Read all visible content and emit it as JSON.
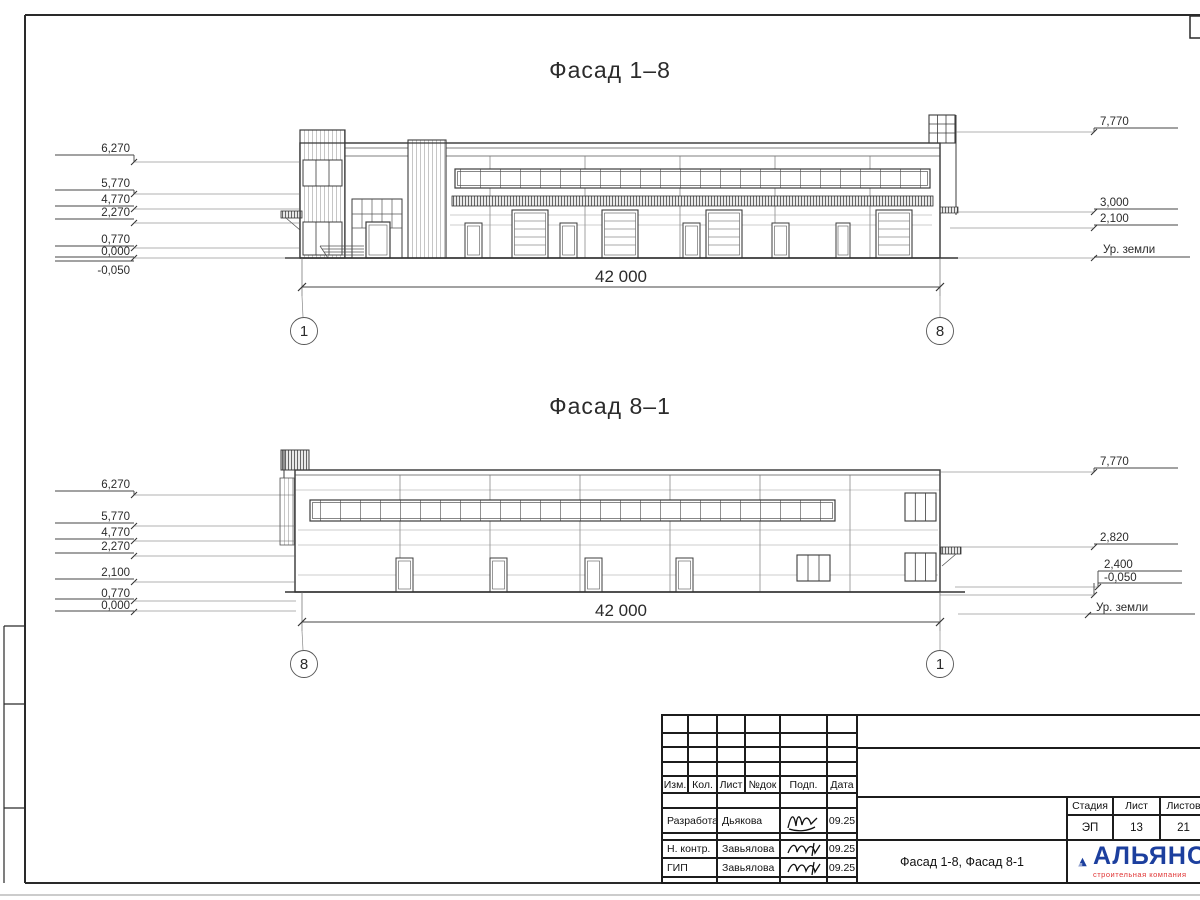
{
  "drawing": {
    "facade_top": {
      "title": "Фасад 1–8",
      "marks_left": [
        "6,270",
        "5,770",
        "4,770",
        "2,270",
        "0,770",
        "0,000",
        "-0,050"
      ],
      "marks_right": [
        "7,770",
        "3,000",
        "2,100"
      ],
      "ground_label": "Ур. земли",
      "dimension": "42 000",
      "axis_left": "1",
      "axis_right": "8"
    },
    "facade_bottom": {
      "title": "Фасад 8–1",
      "marks_left": [
        "6,270",
        "5,770",
        "4,770",
        "2,270",
        "2,100",
        "0,770",
        "0,000"
      ],
      "marks_right": [
        "7,770",
        "2,820",
        "2,400",
        "-0,050"
      ],
      "ground_label": "Ур. земли",
      "dimension": "42 000",
      "axis_left": "8",
      "axis_right": "1"
    }
  },
  "titleblock": {
    "columns": {
      "izm": "Изм.",
      "kol": "Кол.",
      "list": "Лист",
      "ndok": "№док",
      "podp": "Подп.",
      "data": "Дата"
    },
    "rows": [
      {
        "role": "Разработал",
        "name": "Дьякова",
        "date": "09.25"
      },
      {
        "role": "Н. контр.",
        "name": "Завьялова",
        "date": "09.25"
      },
      {
        "role": "ГИП",
        "name": "Завьялова",
        "date": "09.25"
      }
    ],
    "doc_title": "Фасад 1-8, Фасад 8-1",
    "stage_label": "Стадия",
    "sheet_label": "Лист",
    "sheets_label": "Листов",
    "stage": "ЭП",
    "sheet": "13",
    "sheets": "21",
    "logo_name": "АЛЬЯНС",
    "logo_subtitle": "строительная компания"
  },
  "colors": {
    "line": "#3c3c3c",
    "logo_blue": "#1c3f9e",
    "logo_red": "#e03535"
  }
}
